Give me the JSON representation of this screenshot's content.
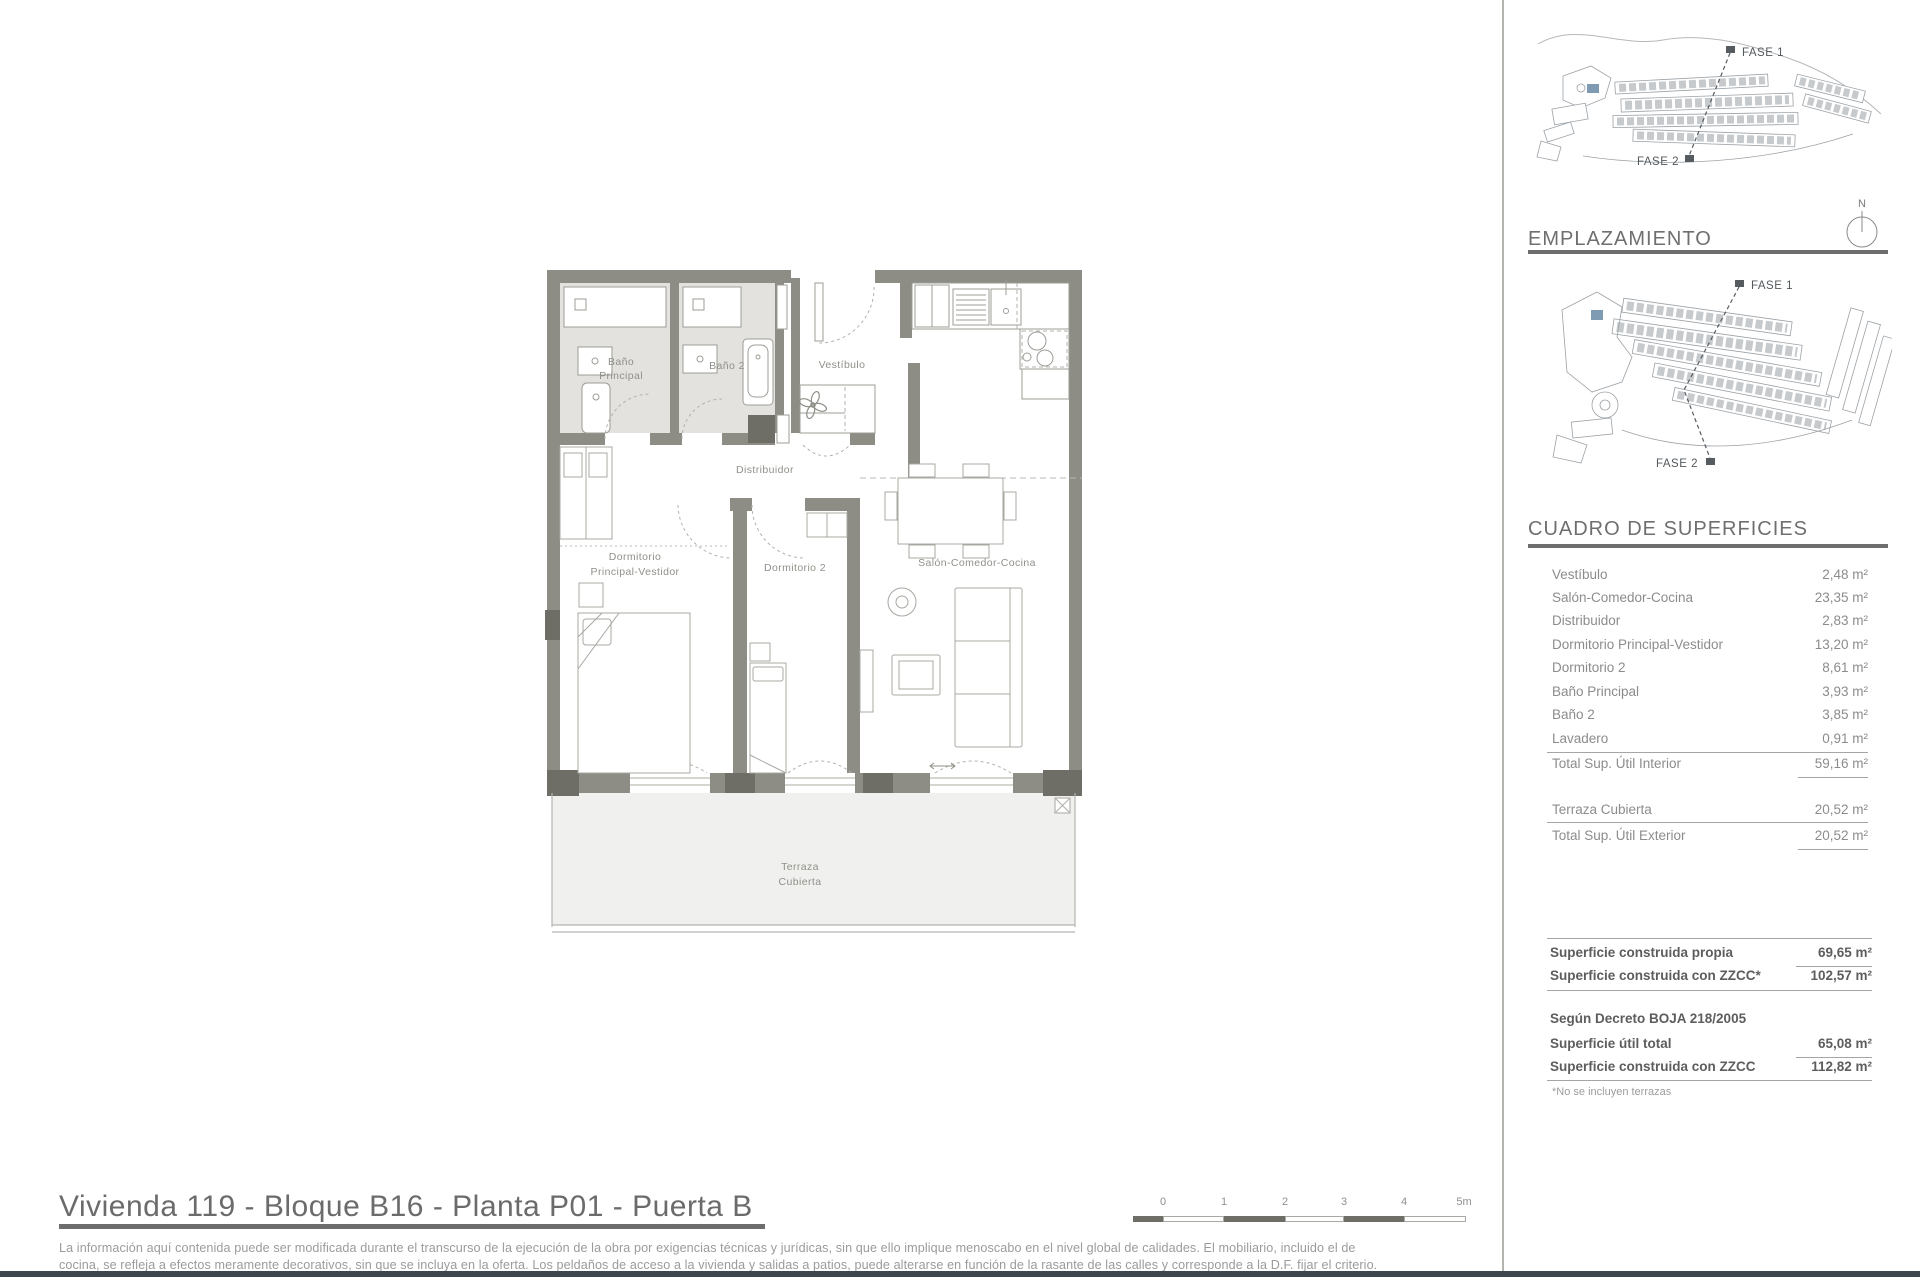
{
  "plan": {
    "labels": {
      "bano_principal_l1": "Baño",
      "bano_principal_l2": "Principal",
      "bano2": "Baño 2",
      "vestibulo": "Vestíbulo",
      "distribuidor": "Distribuidor",
      "dorm_ppal_l1": "Dormitorio",
      "dorm_ppal_l2": "Principal-Vestidor",
      "dorm2": "Dormitorio 2",
      "salon": "Salón-Comedor-Cocina",
      "terraza_l1": "Terraza",
      "terraza_l2": "Cubierta"
    }
  },
  "sidebar": {
    "site_plan_top": {
      "fase1": "FASE 1",
      "fase2": "FASE 2"
    },
    "emplazamiento": {
      "heading": "EMPLAZAMIENTO",
      "fase1": "FASE 1",
      "fase2": "FASE 2",
      "north": "N"
    },
    "superficies": {
      "heading": "CUADRO DE SUPERFICIES",
      "rows": [
        {
          "label": "Vestíbulo",
          "value": "2,48 m²"
        },
        {
          "label": "Salón-Comedor-Cocina",
          "value": "23,35 m²"
        },
        {
          "label": "Distribuidor",
          "value": "2,83 m²"
        },
        {
          "label": "Dormitorio Principal-Vestidor",
          "value": "13,20 m²"
        },
        {
          "label": "Dormitorio 2",
          "value": "8,61 m²"
        },
        {
          "label": "Baño Principal",
          "value": "3,93 m²"
        },
        {
          "label": "Baño 2",
          "value": "3,85 m²"
        },
        {
          "label": "Lavadero",
          "value": "0,91 m²"
        }
      ],
      "total_interior": {
        "label": "Total Sup. Útil Interior",
        "value": "59,16 m²"
      },
      "terraza_row": {
        "label": "Terraza Cubierta",
        "value": "20,52 m²"
      },
      "total_exterior": {
        "label": "Total Sup. Útil Exterior",
        "value": "20,52 m²"
      }
    },
    "totals": {
      "construida_propia": {
        "label": "Superficie construida propia",
        "value": "69,65 m²"
      },
      "construida_zzcc": {
        "label": "Superficie construida con ZZCC*",
        "value": "102,57 m²"
      },
      "decreto_heading": "Según Decreto BOJA 218/2005",
      "util_total": {
        "label": "Superficie útil total",
        "value": "65,08 m²"
      },
      "construida_zzcc2": {
        "label": "Superficie construida con ZZCC",
        "value": "112,82 m²"
      },
      "note": "*No se incluyen terrazas"
    }
  },
  "footer": {
    "title": "Vivienda 119 - Bloque B16 - Planta P01 - Puerta B",
    "disclaimer_line1": "La información aquí contenida puede  ser modificada durante el transcurso de la ejecución de la obra por exigencias técnicas y jurídicas,  sin  que  ello  implique  menoscabo  en el nivel global de calidades.  El  mobiliario, incluido el de",
    "disclaimer_line2": "cocina, se refleja a efectos meramente decorativos, sin que se incluya en la oferta. Los peldaños de acceso a la vivienda y  salidas  a patios,  puede alterarse  en función de la rasante de las calles y corresponde a  la  D.F.  fijar el criterio.",
    "scale_ticks": [
      "0",
      "1",
      "2",
      "3",
      "4",
      "5m"
    ]
  },
  "colors": {
    "wall": "#8d8d85",
    "wall_dark": "#6e6e66",
    "bath_floor": "#e3e2df",
    "terrace_floor": "#f0f0ee",
    "phase_blue": "#7e9bb3",
    "footer_bar": "#3e464e"
  }
}
